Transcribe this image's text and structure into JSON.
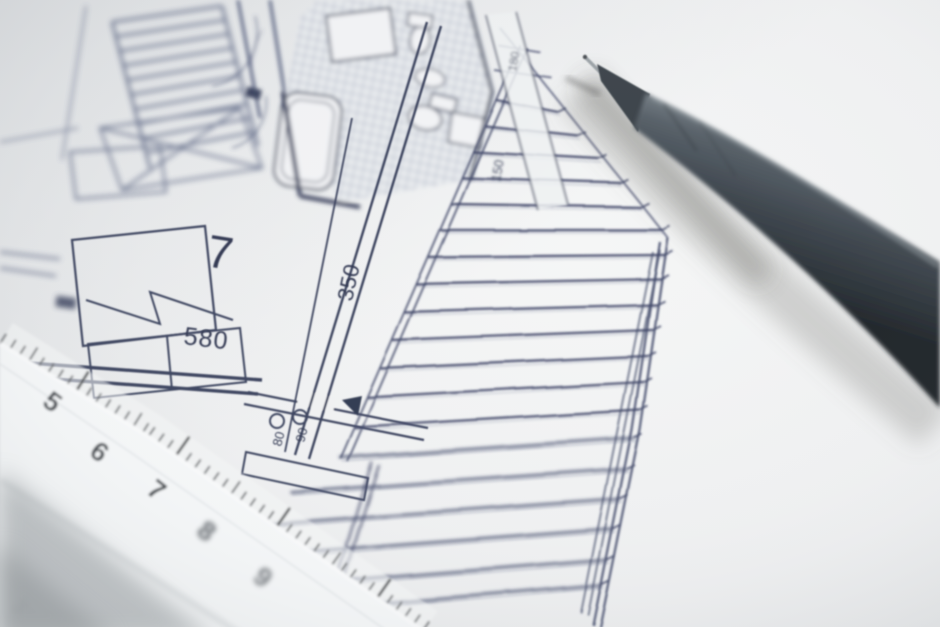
{
  "scene": {
    "alt": "Close-up photograph of an architectural floor plan with a white ruler and a dark grey fineliner pen"
  },
  "plan": {
    "room_number": "7",
    "dim_width": "580",
    "dim_height": "350",
    "dim_door_a": "80",
    "dim_door_b": "90",
    "dim_edge_a": "180",
    "dim_edge_b": "150"
  },
  "ruler": {
    "numbers": [
      "5",
      "6",
      "7",
      "8",
      "9"
    ],
    "faint": "3"
  }
}
